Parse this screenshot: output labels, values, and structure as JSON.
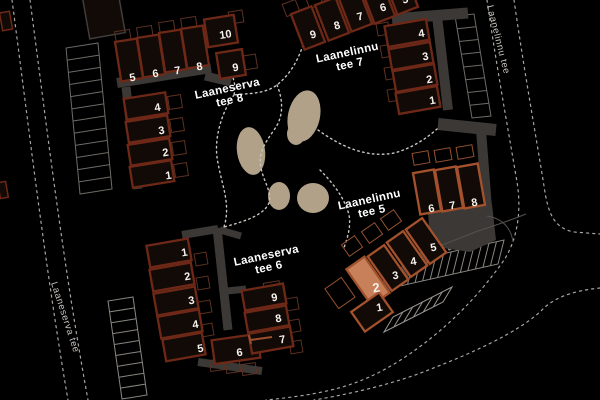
{
  "map": {
    "background": "#000000",
    "colors": {
      "building_fill": "#120a06",
      "building_outline": "#6e2817",
      "building_outline_alt": "#a4522e",
      "highlight_fill": "#c8805a",
      "highlight_outline": "#a0522d",
      "pavement": "#3b3835",
      "road_edge": "#55514d",
      "road_dash": "#a8a4a0",
      "path_dash": "#c9c5c0",
      "blob": "#b1a189",
      "number_text": "#f5f1ec",
      "label_text": "#ffffff",
      "street_text": "#c8c4bf",
      "mark": "#9c4f2e",
      "garage_outline": "#413d3a"
    },
    "streets": [
      {
        "name": "Laanelinnu tee",
        "x": 487,
        "y": 6,
        "rot": 76
      },
      {
        "name": "Laaneserva tee",
        "x": 51,
        "y": 283,
        "rot": 72
      }
    ],
    "clusters": [
      {
        "id": "laaneserva-tee-8",
        "label": "Laaneserva tee 8",
        "label_lines": [
          "Laaneserva",
          "tee 8"
        ],
        "label_x": 228,
        "label_y": 92,
        "label_rot": -12,
        "outline": "#6e2817",
        "patio_color": "#5d3122",
        "units": [
          {
            "n": "5",
            "cx": 129,
            "cy": 60,
            "w": 22,
            "h": 40,
            "a": -9,
            "tr": -9,
            "nx": 133,
            "ny": 81
          },
          {
            "n": "6",
            "cx": 151,
            "cy": 56,
            "w": 22,
            "h": 40,
            "a": -9,
            "tr": -9,
            "nx": 156,
            "ny": 77
          },
          {
            "n": "7",
            "cx": 173,
            "cy": 51,
            "w": 22,
            "h": 40,
            "a": -9,
            "tr": -9,
            "nx": 178,
            "ny": 74
          },
          {
            "n": "8",
            "cx": 195,
            "cy": 47,
            "w": 22,
            "h": 40,
            "a": -9,
            "tr": -9,
            "nx": 200,
            "ny": 70
          },
          {
            "n": "10",
            "cx": 221,
            "cy": 31,
            "w": 30,
            "h": 28,
            "a": -9,
            "tr": -9,
            "nx": 226,
            "ny": 38
          },
          {
            "n": "9",
            "cx": 231,
            "cy": 64,
            "w": 26,
            "h": 26,
            "a": -9,
            "tr": -9,
            "nx": 236,
            "ny": 71
          },
          {
            "n": "4",
            "cx": 146,
            "cy": 106,
            "w": 42,
            "h": 21,
            "a": -9,
            "tr": -9,
            "nx": 158,
            "ny": 111
          },
          {
            "n": "3",
            "cx": 148,
            "cy": 129,
            "w": 42,
            "h": 21,
            "a": -9,
            "tr": -9,
            "nx": 162,
            "ny": 134
          },
          {
            "n": "2",
            "cx": 150,
            "cy": 152,
            "w": 42,
            "h": 21,
            "a": -9,
            "tr": -9,
            "nx": 166,
            "ny": 156
          },
          {
            "n": "1",
            "cx": 152,
            "cy": 174,
            "w": 42,
            "h": 21,
            "a": -9,
            "tr": -9,
            "nx": 169,
            "ny": 179
          }
        ],
        "patios": [
          {
            "cx": 123,
            "cy": 37,
            "w": 15,
            "h": 13,
            "a": -9
          },
          {
            "cx": 145,
            "cy": 33,
            "w": 15,
            "h": 13,
            "a": -9
          },
          {
            "cx": 167,
            "cy": 28,
            "w": 15,
            "h": 13,
            "a": -9
          },
          {
            "cx": 189,
            "cy": 24,
            "w": 15,
            "h": 13,
            "a": -9
          },
          {
            "cx": 236,
            "cy": 17,
            "w": 14,
            "h": 12,
            "a": -9
          },
          {
            "cx": 250,
            "cy": 62,
            "w": 13,
            "h": 14,
            "a": -9
          },
          {
            "cx": 175,
            "cy": 102,
            "w": 13,
            "h": 13,
            "a": -9
          },
          {
            "cx": 177,
            "cy": 125,
            "w": 13,
            "h": 13,
            "a": -9
          },
          {
            "cx": 179,
            "cy": 148,
            "w": 13,
            "h": 13,
            "a": -9
          },
          {
            "cx": 181,
            "cy": 170,
            "w": 13,
            "h": 13,
            "a": -9
          }
        ]
      },
      {
        "id": "laanelinnu-tee-7",
        "label": "Laanelinnu tee 7",
        "label_lines": [
          "Laanelinnu",
          "tee 7"
        ],
        "label_x": 348,
        "label_y": 56,
        "label_rot": -12,
        "outline": "#6e2817",
        "patio_color": "#5d3122",
        "units": [
          {
            "n": "9",
            "cx": 308,
            "cy": 28,
            "w": 22,
            "h": 38,
            "a": -21,
            "tr": -15,
            "nx": 314,
            "ny": 38
          },
          {
            "n": "8",
            "cx": 332,
            "cy": 19,
            "w": 22,
            "h": 38,
            "a": -21,
            "tr": -15,
            "nx": 338,
            "ny": 29
          },
          {
            "n": "7",
            "cx": 355,
            "cy": 10,
            "w": 22,
            "h": 38,
            "a": -21,
            "tr": -15,
            "nx": 361,
            "ny": 20
          },
          {
            "n": "6",
            "cx": 378,
            "cy": 2,
            "w": 22,
            "h": 38,
            "a": -21,
            "tr": -15,
            "nx": 384,
            "ny": 11
          },
          {
            "n": "5",
            "cx": 401,
            "cy": -7,
            "w": 22,
            "h": 38,
            "a": -21,
            "tr": -15,
            "nx": 406,
            "ny": 3
          },
          {
            "n": "4",
            "cx": 407,
            "cy": 33,
            "w": 42,
            "h": 21,
            "a": -10,
            "tr": -10,
            "nx": 422,
            "ny": 37
          },
          {
            "n": "3",
            "cx": 411,
            "cy": 56,
            "w": 42,
            "h": 21,
            "a": -10,
            "tr": -10,
            "nx": 426,
            "ny": 60
          },
          {
            "n": "2",
            "cx": 415,
            "cy": 78,
            "w": 42,
            "h": 21,
            "a": -10,
            "tr": -10,
            "nx": 430,
            "ny": 83
          },
          {
            "n": "1",
            "cx": 418,
            "cy": 100,
            "w": 42,
            "h": 21,
            "a": -10,
            "tr": -10,
            "nx": 433,
            "ny": 104
          }
        ],
        "patios": [
          {
            "cx": 291,
            "cy": 8,
            "w": 14,
            "h": 13,
            "a": -21
          },
          {
            "cx": 314,
            "cy": 0,
            "w": 14,
            "h": 13,
            "a": -21
          },
          {
            "cx": 383,
            "cy": 29,
            "w": 12,
            "h": 12,
            "a": -10
          },
          {
            "cx": 387,
            "cy": 51,
            "w": 12,
            "h": 12,
            "a": -10
          },
          {
            "cx": 391,
            "cy": 73,
            "w": 12,
            "h": 12,
            "a": -10
          },
          {
            "cx": 394,
            "cy": 95,
            "w": 12,
            "h": 12,
            "a": -10
          }
        ]
      },
      {
        "id": "laaneserva-tee-6",
        "label": "Laaneserva tee 6",
        "label_lines": [
          "Laaneserva",
          "tee 6"
        ],
        "label_x": 267,
        "label_y": 259,
        "label_rot": -12,
        "outline": "#6e2817",
        "patio_color": "#5d3122",
        "units": [
          {
            "n": "1",
            "cx": 169,
            "cy": 253,
            "w": 42,
            "h": 22,
            "a": -10,
            "tr": -10,
            "nx": 185,
            "ny": 256
          },
          {
            "n": "2",
            "cx": 172,
            "cy": 277,
            "w": 42,
            "h": 22,
            "a": -10,
            "tr": -10,
            "nx": 188,
            "ny": 280
          },
          {
            "n": "3",
            "cx": 176,
            "cy": 301,
            "w": 42,
            "h": 22,
            "a": -10,
            "tr": -10,
            "nx": 192,
            "ny": 304
          },
          {
            "n": "4",
            "cx": 180,
            "cy": 324,
            "w": 42,
            "h": 22,
            "a": -10,
            "tr": -10,
            "nx": 196,
            "ny": 328
          },
          {
            "n": "5",
            "cx": 184,
            "cy": 347,
            "w": 40,
            "h": 22,
            "a": -10,
            "tr": -10,
            "nx": 201,
            "ny": 352
          },
          {
            "n": "6",
            "cx": 236,
            "cy": 349,
            "w": 46,
            "h": 24,
            "a": -8,
            "tr": -8,
            "nx": 240,
            "ny": 356
          },
          {
            "n": "9",
            "cx": 264,
            "cy": 297,
            "w": 42,
            "h": 20,
            "a": -10,
            "tr": -10,
            "nx": 275,
            "ny": 301
          },
          {
            "n": "8",
            "cx": 267,
            "cy": 319,
            "w": 42,
            "h": 20,
            "a": -10,
            "tr": -10,
            "nx": 279,
            "ny": 322
          },
          {
            "n": "7",
            "cx": 271,
            "cy": 340,
            "w": 42,
            "h": 20,
            "a": -10,
            "tr": -10,
            "nx": 283,
            "ny": 343
          }
        ],
        "patios": [
          {
            "cx": 201,
            "cy": 259,
            "w": 12,
            "h": 12,
            "a": -10
          },
          {
            "cx": 203,
            "cy": 283,
            "w": 12,
            "h": 12,
            "a": -10
          },
          {
            "cx": 205,
            "cy": 307,
            "w": 12,
            "h": 12,
            "a": -10
          },
          {
            "cx": 207,
            "cy": 330,
            "w": 12,
            "h": 12,
            "a": -10
          },
          {
            "cx": 292,
            "cy": 304,
            "w": 12,
            "h": 12,
            "a": -10
          },
          {
            "cx": 294,
            "cy": 326,
            "w": 12,
            "h": 12,
            "a": -10
          },
          {
            "cx": 296,
            "cy": 347,
            "w": 12,
            "h": 12,
            "a": -10
          },
          {
            "cx": 217,
            "cy": 365,
            "w": 14,
            "h": 11,
            "a": -8
          },
          {
            "cx": 233,
            "cy": 367,
            "w": 14,
            "h": 11,
            "a": -8
          },
          {
            "cx": 249,
            "cy": 369,
            "w": 14,
            "h": 11,
            "a": -8
          },
          {
            "cx": 272,
            "cy": 287,
            "w": 16,
            "h": 10,
            "a": -10
          }
        ]
      },
      {
        "id": "laanelinnu-tee-5",
        "label": "Laanelinnu tee 5",
        "label_lines": [
          "Laanelinnu",
          "tee 5"
        ],
        "label_x": 370,
        "label_y": 203,
        "label_rot": -12,
        "outline": "#a4522e",
        "patio_color": "#96512f",
        "units": [
          {
            "n": "6",
            "cx": 427,
            "cy": 192,
            "w": 21,
            "h": 42,
            "a": -10,
            "tr": -10,
            "nx": 432,
            "ny": 212
          },
          {
            "n": "7",
            "cx": 449,
            "cy": 189,
            "w": 21,
            "h": 42,
            "a": -10,
            "tr": -10,
            "nx": 453,
            "ny": 209
          },
          {
            "n": "8",
            "cx": 471,
            "cy": 186,
            "w": 21,
            "h": 42,
            "a": -10,
            "tr": -10,
            "nx": 475,
            "ny": 206
          },
          {
            "n": "5",
            "cx": 426,
            "cy": 241,
            "w": 20,
            "h": 42,
            "a": -35,
            "tr": -10,
            "nx": 434,
            "ny": 251
          },
          {
            "n": "4",
            "cx": 407,
            "cy": 254,
            "w": 20,
            "h": 42,
            "a": -35,
            "tr": -10,
            "nx": 414,
            "ny": 265
          },
          {
            "n": "3",
            "cx": 388,
            "cy": 268,
            "w": 20,
            "h": 42,
            "a": -35,
            "tr": -10,
            "nx": 396,
            "ny": 279
          },
          {
            "n": "2",
            "cx": 368,
            "cy": 281,
            "w": 22,
            "h": 44,
            "a": -35,
            "tr": -10,
            "nx": 377,
            "ny": 292,
            "highlight": true
          },
          {
            "n": "1",
            "cx": 372,
            "cy": 312,
            "w": 34,
            "h": 24,
            "a": -35,
            "tr": -10,
            "nx": 380,
            "ny": 311
          }
        ],
        "patios": [
          {
            "cx": 421,
            "cy": 158,
            "w": 16,
            "h": 12,
            "a": -10
          },
          {
            "cx": 443,
            "cy": 155,
            "w": 16,
            "h": 12,
            "a": -10
          },
          {
            "cx": 465,
            "cy": 152,
            "w": 16,
            "h": 12,
            "a": -10
          },
          {
            "cx": 352,
            "cy": 246,
            "w": 16,
            "h": 14,
            "a": -35
          },
          {
            "cx": 372,
            "cy": 233,
            "w": 16,
            "h": 14,
            "a": -35
          },
          {
            "cx": 391,
            "cy": 220,
            "w": 16,
            "h": 14,
            "a": -35
          },
          {
            "cx": 340,
            "cy": 293,
            "w": 20,
            "h": 24,
            "a": -35
          }
        ]
      }
    ],
    "blobs": [
      {
        "cx": 304,
        "cy": 116,
        "rx": 16,
        "ry": 26,
        "rot": 12
      },
      {
        "cx": 296,
        "cy": 134,
        "rx": 9,
        "ry": 11,
        "rot": 0
      },
      {
        "cx": 251,
        "cy": 151,
        "rx": 14,
        "ry": 24,
        "rot": -8
      },
      {
        "cx": 279,
        "cy": 196,
        "rx": 11,
        "ry": 14,
        "rot": 0
      },
      {
        "cx": 313,
        "cy": 198,
        "rx": 16,
        "ry": 15,
        "rot": 0
      }
    ],
    "pavement_lines": [
      {
        "x1": 117,
        "y1": 83,
        "x2": 211,
        "y2": 68,
        "w": 10
      },
      {
        "x1": 205,
        "y1": 76,
        "x2": 231,
        "y2": 82,
        "w": 9
      },
      {
        "x1": 126,
        "y1": 87,
        "x2": 138,
        "y2": 189,
        "w": 9
      },
      {
        "x1": 392,
        "y1": 19,
        "x2": 468,
        "y2": 13,
        "w": 11
      },
      {
        "x1": 437,
        "y1": 16,
        "x2": 448,
        "y2": 110,
        "w": 10
      },
      {
        "x1": 438,
        "y1": 124,
        "x2": 496,
        "y2": 130,
        "w": 12
      },
      {
        "x1": 481,
        "y1": 130,
        "x2": 487,
        "y2": 208,
        "w": 10
      },
      {
        "x1": 182,
        "y1": 235,
        "x2": 218,
        "y2": 229,
        "w": 8
      },
      {
        "x1": 217,
        "y1": 228,
        "x2": 228,
        "y2": 330,
        "w": 9
      },
      {
        "x1": 227,
        "y1": 291,
        "x2": 246,
        "y2": 289,
        "w": 7
      },
      {
        "x1": 198,
        "y1": 362,
        "x2": 262,
        "y2": 371,
        "w": 8
      },
      {
        "x1": 220,
        "y1": 230,
        "x2": 241,
        "y2": 236,
        "w": 7
      },
      {
        "x1": 368,
        "y1": 300,
        "x2": 430,
        "y2": 252,
        "w": 12
      }
    ],
    "pavement_polys": [
      {
        "points": "428,212 492,204 496,240 470,252 430,246"
      }
    ],
    "road_edges": [
      {
        "d": "M432,249 L478,231 Q506,222 526,214"
      },
      {
        "d": "M487,216 Q510,220 513,242"
      }
    ],
    "roads": [
      {
        "d": "M12,0 C28,120 44,260 68,400"
      },
      {
        "d": "M30,0 C46,120 62,258 88,400"
      },
      {
        "d": "M487,0 C497,70 510,140 517,182 C522,212 517,242 502,263 C478,296 446,331 399,361 C359,386 326,394 266,400"
      },
      {
        "d": "M514,0 C524,70 537,142 544,186 C548,214 554,228 574,232 L600,234"
      },
      {
        "d": "M600,288 C570,291 552,299 541,311 C517,333 472,353 431,369 C396,383 356,393 314,400"
      }
    ],
    "footpaths": [
      {
        "d": "M220,57 C231,70 237,81 234,95"
      },
      {
        "d": "M234,95 C221,113 213,141 218,163 C222,186 231,204 224,227"
      },
      {
        "d": "M303,45 C297,63 289,75 277,85 C263,95 247,93 234,95"
      },
      {
        "d": "M277,85 C284,102 283,118 274,130 C265,143 258,153 261,168 C264,183 272,191 269,203"
      },
      {
        "d": "M269,203 C264,214 250,220 224,227"
      },
      {
        "d": "M318,130 C343,148 368,158 394,153 C410,149 426,139 437,129"
      },
      {
        "d": "M320,170 C334,184 345,199 349,215 C351,226 348,236 344,248"
      }
    ],
    "combs": [
      {
        "x1": 66,
        "y1": 48,
        "x2": 80,
        "y2": 194,
        "dx": 32,
        "dy": -5,
        "n": 12,
        "color": "#6e6a66"
      },
      {
        "x1": 108,
        "y1": 301,
        "x2": 122,
        "y2": 399,
        "dx": 25,
        "dy": -4,
        "n": 9,
        "color": "#8a8681"
      },
      {
        "x1": 455,
        "y1": 16,
        "x2": 472,
        "y2": 118,
        "dx": 19,
        "dy": -2,
        "n": 8,
        "color": "#6e6a66"
      },
      {
        "x1": 406,
        "y1": 262,
        "x2": 504,
        "y2": 240,
        "dx": -6,
        "dy": 24,
        "n": 13,
        "color": "#8a8681"
      },
      {
        "x1": 384,
        "y1": 332,
        "x2": 443,
        "y2": 302,
        "dx": 9,
        "dy": -15,
        "n": 6,
        "color": "#9a9691"
      },
      {
        "x1": 449,
        "y1": 250,
        "x2": 478,
        "y2": 235,
        "dx": -8,
        "dy": -14,
        "n": 4,
        "color": "#9a9691"
      }
    ],
    "marks": [
      {
        "x1": 250,
        "y1": 340,
        "x2": 272,
        "y2": 337,
        "w": 2
      },
      {
        "x1": 249,
        "y1": 335,
        "x2": 251,
        "y2": 344,
        "w": 2
      }
    ],
    "fragments": [
      {
        "cx": 6,
        "cy": 21,
        "w": 10,
        "h": 18,
        "a": -10,
        "color": "#6e2817"
      },
      {
        "cx": 3,
        "cy": 190,
        "w": 8,
        "h": 16,
        "a": -10,
        "color": "#6e2817"
      },
      {
        "cx": 104,
        "cy": 16,
        "w": 36,
        "h": 40,
        "a": -10,
        "color": "#413d3a"
      }
    ]
  }
}
